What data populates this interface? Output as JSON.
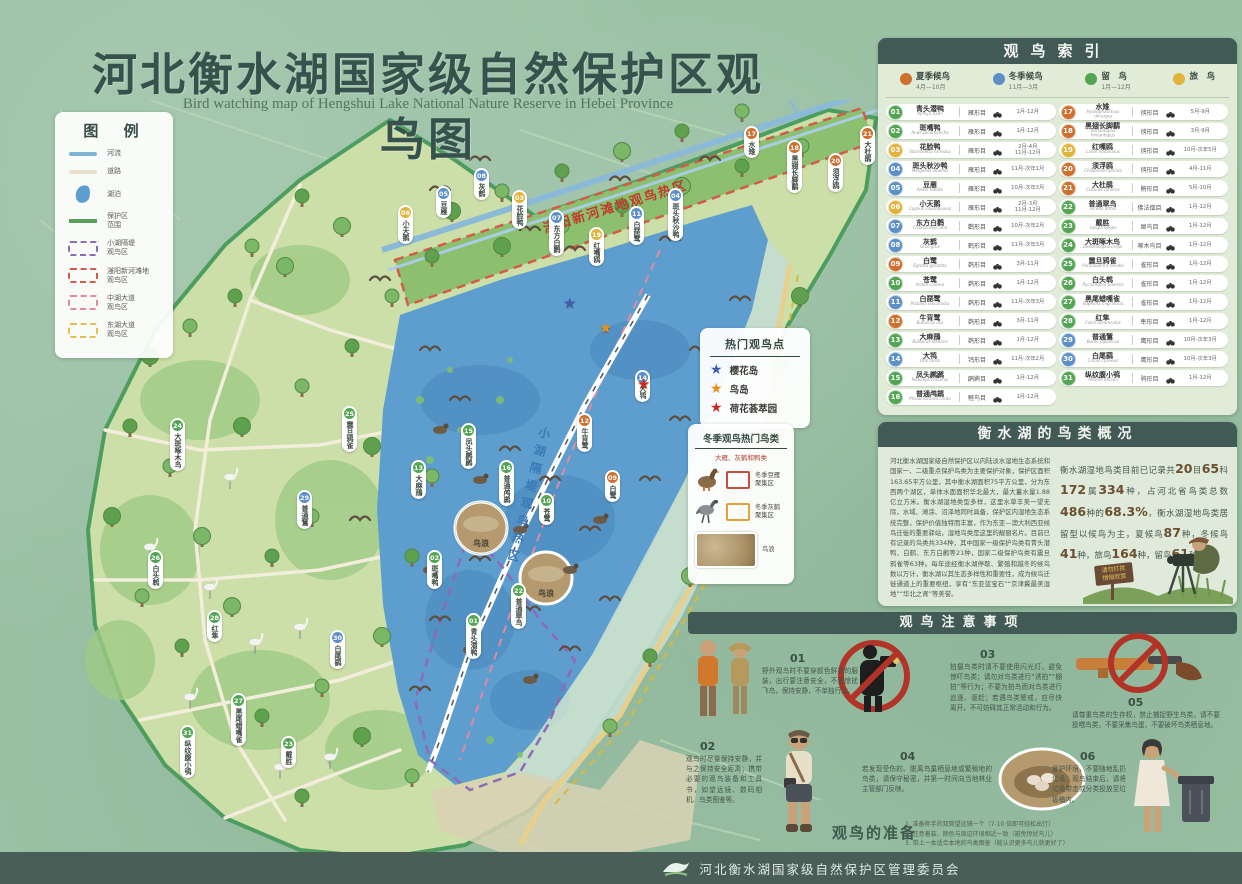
{
  "title": "河北衡水湖国家级自然保护区观鸟图",
  "subtitle": "Bird watching map of Hengshui Lake National Nature Reserve in Hebei Province",
  "legend": {
    "title": "图 例",
    "items": [
      {
        "symbol": "river-line",
        "style": "river",
        "label": "河流"
      },
      {
        "symbol": "road-line",
        "style": "road",
        "label": "道路"
      },
      {
        "symbol": "lake-shape",
        "style": "lake",
        "label": "湖泊"
      },
      {
        "symbol": "reserve-boundary-line",
        "style": "bound",
        "label": "保护区\n范围"
      },
      {
        "symbol": "purple-dashed-box",
        "style": "dash",
        "color": "#8e6bb5",
        "label": "小湖隔堤\n观鸟区"
      },
      {
        "symbol": "red-dashed-box",
        "style": "dash",
        "color": "#d45a4a",
        "label": "滏阳新河滩地\n观鸟区"
      },
      {
        "symbol": "pink-dashed-box",
        "style": "dash",
        "color": "#e08aa0",
        "label": "中湖大道\n观鸟区"
      },
      {
        "symbol": "yellow-dashed-box",
        "style": "dash",
        "color": "#e0c34f",
        "label": "东湖大道\n观鸟区"
      }
    ]
  },
  "map": {
    "zone_labels": [
      {
        "text": "滏阳新河滩地观鸟热区",
        "color": "#c03a2c"
      },
      {
        "text": "小湖隔堤观鸟热区",
        "color": "#3a7ab8"
      }
    ],
    "photo_inset_label": "鸟浪",
    "markers": [
      {
        "num": "06",
        "x": 398,
        "y": 205
      },
      {
        "num": "05",
        "x": 436,
        "y": 186
      },
      {
        "num": "08",
        "x": 474,
        "y": 168
      },
      {
        "num": "03",
        "x": 512,
        "y": 190
      },
      {
        "num": "07",
        "x": 549,
        "y": 210
      },
      {
        "num": "19",
        "x": 589,
        "y": 227
      },
      {
        "num": "11",
        "x": 629,
        "y": 206
      },
      {
        "num": "04",
        "x": 668,
        "y": 188
      },
      {
        "num": "17",
        "x": 744,
        "y": 126
      },
      {
        "num": "18",
        "x": 787,
        "y": 140
      },
      {
        "num": "20",
        "x": 828,
        "y": 153
      },
      {
        "num": "21",
        "x": 860,
        "y": 126
      },
      {
        "num": "24",
        "x": 170,
        "y": 418
      },
      {
        "num": "29",
        "x": 297,
        "y": 490
      },
      {
        "num": "25",
        "x": 342,
        "y": 406
      },
      {
        "num": "26",
        "x": 148,
        "y": 550
      },
      {
        "num": "28",
        "x": 207,
        "y": 610
      },
      {
        "num": "30",
        "x": 330,
        "y": 630
      },
      {
        "num": "27",
        "x": 231,
        "y": 693
      },
      {
        "num": "31",
        "x": 180,
        "y": 725
      },
      {
        "num": "23",
        "x": 281,
        "y": 736
      },
      {
        "num": "13",
        "x": 411,
        "y": 460
      },
      {
        "num": "15",
        "x": 461,
        "y": 423
      },
      {
        "num": "16",
        "x": 499,
        "y": 460
      },
      {
        "num": "10",
        "x": 539,
        "y": 493
      },
      {
        "num": "12",
        "x": 577,
        "y": 413
      },
      {
        "num": "09",
        "x": 605,
        "y": 470
      },
      {
        "num": "14",
        "x": 635,
        "y": 370
      },
      {
        "num": "02",
        "x": 427,
        "y": 550
      },
      {
        "num": "01",
        "x": 466,
        "y": 613
      },
      {
        "num": "22",
        "x": 511,
        "y": 583
      }
    ]
  },
  "hotspots": {
    "title": "热门观鸟点",
    "items": [
      {
        "color": "#3f5fae",
        "label": "樱花岛"
      },
      {
        "color": "#e2921f",
        "label": "鸟岛"
      },
      {
        "color": "#cc2b20",
        "label": "荷花荟萃园"
      }
    ]
  },
  "winter": {
    "title": "冬季观鸟热门鸟类",
    "subtitle": "大雁、灰鹤和鸭类",
    "rows": [
      {
        "icon": "goose-icon",
        "box_color": "#c94f3d",
        "label": "冬季豆雁\n聚集区"
      },
      {
        "icon": "crane-icon",
        "box_color": "#e0a33c",
        "label": "冬季灰鹤\n聚集区"
      }
    ],
    "photo_label": "鸟浪"
  },
  "index": {
    "title": "观鸟索引",
    "season_colors": {
      "summer": "#cd7030",
      "winter": "#5c8fc7",
      "resident": "#53a553",
      "passage": "#e2b33c"
    },
    "seasons": [
      {
        "key": "summer",
        "label": "夏季候鸟",
        "months": "4月—10月"
      },
      {
        "key": "winter",
        "label": "冬季候鸟",
        "months": "11月—3月"
      },
      {
        "key": "resident",
        "label": "留　鸟",
        "months": "1月—12月"
      },
      {
        "key": "passage",
        "label": "旅　鸟",
        "months": ""
      }
    ],
    "birds": [
      {
        "num": "01",
        "name": "青头潜鸭",
        "latin": "Aythya baeri",
        "order": "雁形目",
        "months": [
          "1月-12月"
        ],
        "season": "resident"
      },
      {
        "num": "02",
        "name": "斑嘴鸭",
        "latin": "Anas zonorhyncha",
        "order": "雁形目",
        "months": [
          "1月-12月"
        ],
        "season": "resident"
      },
      {
        "num": "03",
        "name": "花脸鸭",
        "latin": "Sibirionetta formosa",
        "order": "雁形目",
        "months": [
          "2月-4月",
          "11月-12月"
        ],
        "season": "passage"
      },
      {
        "num": "04",
        "name": "斑头秋沙鸭",
        "latin": "Mergellus albellus",
        "order": "雁形目",
        "months": [
          "11月-次年1月"
        ],
        "season": "winter"
      },
      {
        "num": "05",
        "name": "豆雁",
        "latin": "Anser fabalis",
        "order": "雁形目",
        "months": [
          "10月-次年3月"
        ],
        "season": "winter"
      },
      {
        "num": "06",
        "name": "小天鹅",
        "latin": "Cygnus columbianus",
        "order": "雁形目",
        "months": [
          "2月-3月",
          "11月-12月"
        ],
        "season": "passage"
      },
      {
        "num": "07",
        "name": "东方白鹳",
        "latin": "Ciconia boyciana",
        "order": "鹳形目",
        "months": [
          "10月-次年2月"
        ],
        "season": "winter"
      },
      {
        "num": "08",
        "name": "灰鹤",
        "latin": "Grus grus",
        "order": "鹤形目",
        "months": [
          "11月-次年3月"
        ],
        "season": "winter"
      },
      {
        "num": "09",
        "name": "白鹭",
        "latin": "Egretta garzetta",
        "order": "鹈形目",
        "months": [
          "3月-11月"
        ],
        "season": "summer"
      },
      {
        "num": "10",
        "name": "苍鹭",
        "latin": "Ardea cinerea",
        "order": "鹈形目",
        "months": [
          "1月-12月"
        ],
        "season": "resident"
      },
      {
        "num": "11",
        "name": "白琵鹭",
        "latin": "Platalea leucorodia",
        "order": "鹈形目",
        "months": [
          "11月-次年3月"
        ],
        "season": "winter"
      },
      {
        "num": "12",
        "name": "牛背鹭",
        "latin": "Bubulcus ibis",
        "order": "鹈形目",
        "months": [
          "3月-11月"
        ],
        "season": "summer"
      },
      {
        "num": "13",
        "name": "大麻鳽",
        "latin": "Botaurus stellaris",
        "order": "鹈形目",
        "months": [
          "1月-12月"
        ],
        "season": "resident"
      },
      {
        "num": "14",
        "name": "大鸨",
        "latin": "Otis tarda",
        "order": "鸨形目",
        "months": [
          "11月-次年2月"
        ],
        "season": "winter"
      },
      {
        "num": "15",
        "name": "凤头䴙䴘",
        "latin": "Podiceps cristatus",
        "order": "䴙䴘目",
        "months": [
          "1月-12月"
        ],
        "season": "resident"
      },
      {
        "num": "16",
        "name": "普通鸬鹚",
        "latin": "Phalacrocorax carbo",
        "order": "鲣鸟目",
        "months": [
          "1月-12月"
        ],
        "season": "resident"
      },
      {
        "num": "17",
        "name": "水雉",
        "latin": "Hydrophasianus chirurgus",
        "order": "鸻形目",
        "months": [
          "5月-9月"
        ],
        "season": "summer"
      },
      {
        "num": "18",
        "name": "黑翅长脚鹬",
        "latin": "Himantopus himantopus",
        "order": "鸻形目",
        "months": [
          "3月-9月"
        ],
        "season": "summer"
      },
      {
        "num": "19",
        "name": "红嘴鸥",
        "latin": "Larus ridibundus",
        "order": "鸻形目",
        "months": [
          "10月-次年5月"
        ],
        "season": "passage"
      },
      {
        "num": "20",
        "name": "须浮鸥",
        "latin": "Chlidonias hybrida",
        "order": "鸻形目",
        "months": [
          "4月-11月"
        ],
        "season": "summer"
      },
      {
        "num": "21",
        "name": "大杜鹃",
        "latin": "Cuculus canorus",
        "order": "鹃形目",
        "months": [
          "5月-10月"
        ],
        "season": "summer"
      },
      {
        "num": "22",
        "name": "普通翠鸟",
        "latin": "Alcedo atthis",
        "order": "佛法僧目",
        "months": [
          "1月-12月"
        ],
        "season": "resident"
      },
      {
        "num": "23",
        "name": "戴胜",
        "latin": "Upupa epops",
        "order": "犀鸟目",
        "months": [
          "1月-12月"
        ],
        "season": "resident"
      },
      {
        "num": "24",
        "name": "大斑啄木鸟",
        "latin": "Dendrocopos major",
        "order": "啄木鸟目",
        "months": [
          "1月-12月"
        ],
        "season": "resident"
      },
      {
        "num": "25",
        "name": "震旦鸦雀",
        "latin": "Paradoxornis heudei",
        "order": "雀形目",
        "months": [
          "1月-12月"
        ],
        "season": "resident"
      },
      {
        "num": "26",
        "name": "白头鹎",
        "latin": "Pycnonotus sinensis",
        "order": "雀形目",
        "months": [
          "1月-12月"
        ],
        "season": "resident"
      },
      {
        "num": "27",
        "name": "黑尾蜡嘴雀",
        "latin": "Eophona migratoria",
        "order": "雀形目",
        "months": [
          "1月-12月"
        ],
        "season": "resident"
      },
      {
        "num": "28",
        "name": "红隼",
        "latin": "Falco tinnunculus",
        "order": "隼形目",
        "months": [
          "1月-12月"
        ],
        "season": "resident"
      },
      {
        "num": "29",
        "name": "普通鵟",
        "latin": "Buteo japonicus",
        "order": "鹰形目",
        "months": [
          "10月-次年3月"
        ],
        "season": "winter"
      },
      {
        "num": "30",
        "name": "白尾鹞",
        "latin": "Circus cyaneus",
        "order": "鹰形目",
        "months": [
          "10月-次年3月"
        ],
        "season": "winter"
      },
      {
        "num": "31",
        "name": "纵纹腹小鸮",
        "latin": "Athene noctua",
        "order": "鸮形目",
        "months": [
          "1月-12月"
        ],
        "season": "resident"
      }
    ]
  },
  "overview": {
    "title": "衡水湖的鸟类概况",
    "left_text": "河北衡水湖国家级自然保护区以内陆淡水湿地生态系统和国家一、二级重点保护鸟类为主要保护对象，保护区面积163.65平方公里，其中衡水湖面积75平方公里，分为东西两个湖区，单体水面面积华北最大，最大蓄水量1.88亿立方米。衡水湖湿地类型多样，这里水草丰美一望无际，水域、滩涂、沼泽地同时具备，保护区内湿地生态系统完整，保护价值独特而丰富，作为东亚—澳大利西亚候鸟迁徙的重要驿站，湿地鸟类是这里的靓丽名片。目前已有记录的鸟类共334种，其中国家一级保护鸟类有青头潜鸭、白鹤、东方白鹳等21种，国家二级保护鸟类有震旦鸦雀等63种。每年途经衡水湖停歇、繁殖和越冬的候鸟数以万计，衡水湖以其生态多样性和重要性，成为候鸟迁徙通道上的重要枢纽，享有“东亚蓝宝石”“京津冀最美湿地”“华北之肾”等美誉。",
    "right_segments": [
      {
        "t": "衡水湖湿地鸟类目前已记录共"
      },
      {
        "t": "20",
        "n": true
      },
      {
        "t": "目"
      },
      {
        "t": "65",
        "n": true
      },
      {
        "t": "科"
      },
      {
        "t": "172",
        "n": true
      },
      {
        "t": "属"
      },
      {
        "t": "334",
        "n": true
      },
      {
        "t": "种，占河北省鸟类总数"
      },
      {
        "t": "486",
        "n": true
      },
      {
        "t": "种的"
      },
      {
        "t": "68.3%",
        "n": true
      },
      {
        "t": "，衡水湖湿地鸟类居留型以候鸟为主，夏候鸟"
      },
      {
        "t": "87",
        "n": true
      },
      {
        "t": "种，冬候鸟"
      },
      {
        "t": "41",
        "n": true
      },
      {
        "t": "种，旅鸟"
      },
      {
        "t": "164",
        "n": true
      },
      {
        "t": "种，留鸟"
      },
      {
        "t": "61",
        "n": true
      },
      {
        "t": "种。"
      }
    ],
    "sign_text": "请勿打扰\n悄悄欣赏"
  },
  "precautions": {
    "title": "观鸟注意事项",
    "items": [
      {
        "num": "01",
        "text": "野外观鸟时不要穿颜色鲜艳的服装，出行要注意安全，不要惊扰飞鸟，保持安静，不单独行动。"
      },
      {
        "num": "02",
        "text": "观鸟时尽量保持安静，并与之保持安全距离；携带必要的观鸟装备和工具书，如望远镜、数码相机、鸟类图鉴等。"
      },
      {
        "num": "03",
        "text": "拍摄鸟类时请不要使用闪光灯，避免惊吓鸟类；请勿对鸟类进行“诱拍”“棚拍”等行为；不要为拍鸟而对鸟类进行追逐、驱赶；若遇鸟类警戒，应尽快离开，不可妨碍其正常活动和行为。"
      },
      {
        "num": "04",
        "text": "若发现受伤的、脱离鸟巢栖息地或繁殖地的鸟类，请保守秘密，并第一时间向当地林业主管部门反映。"
      },
      {
        "num": "05",
        "text": "请尊重鸟类的生存权，禁止捕捉野生鸟类，请不要投喂鸟类，不要采集鸟蛋，不要破坏鸟类栖息地。"
      },
      {
        "num": "06",
        "text": "爱护环境，不要随地乱扔垃圾；观鸟结束后，请将垃圾带走或分类投放至垃圾桶内。"
      }
    ]
  },
  "prep": {
    "title": "观鸟的准备",
    "lines": [
      "1. 准备称手的双筒望远镜一个（7-10 倍即可轻松出行）",
      "2. 注意着装，颜色与周边环境相近一致（避免惊扰鸟儿）",
      "3. 带上一本适合本地的鸟类图鉴（能认识更多鸟儿就更好了）"
    ]
  },
  "footer": {
    "org": "河北衡水湖国家级自然保护区管理委员会"
  }
}
